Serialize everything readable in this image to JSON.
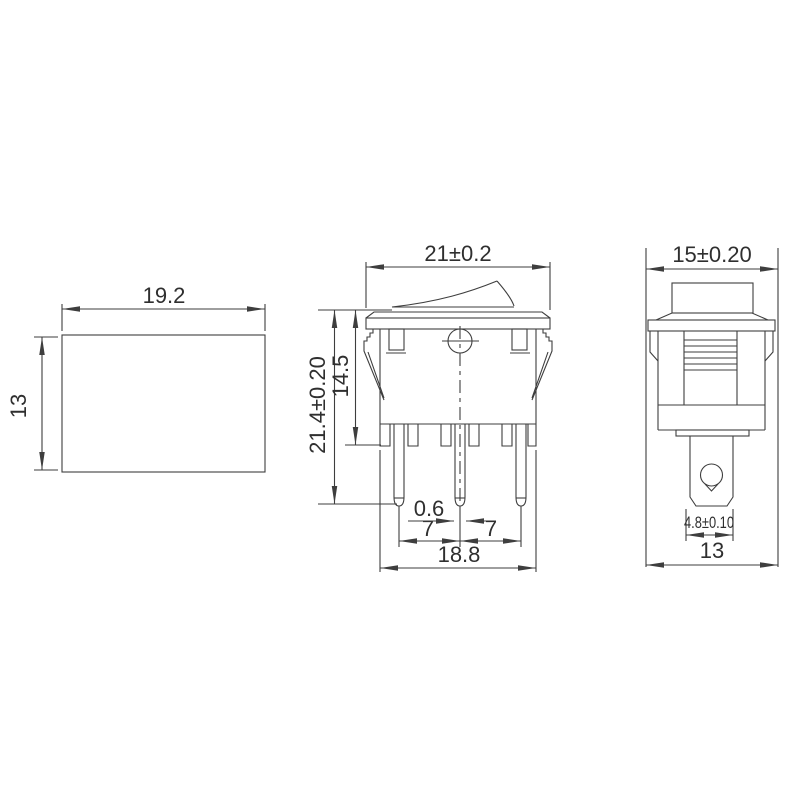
{
  "drawing": {
    "type": "technical-dimension-drawing",
    "subject": "rocker-switch-three-views",
    "colors": {
      "line": "#3e3e3e",
      "text": "#2f2f2f",
      "background": "#ffffff"
    },
    "dims": {
      "top": {
        "width": "19.2",
        "height": "13"
      },
      "front": {
        "top_width": "21±0.2",
        "overall_height": "21.4±0.20",
        "upper_height": "14.5",
        "pin_thickness": "0.6",
        "pitch_left": "7",
        "pitch_right": "7",
        "pin_span": "18.8"
      },
      "side": {
        "top_width": "15±0.20",
        "terminal_width": "4.8±0.10",
        "bottom_width": "13"
      }
    }
  }
}
